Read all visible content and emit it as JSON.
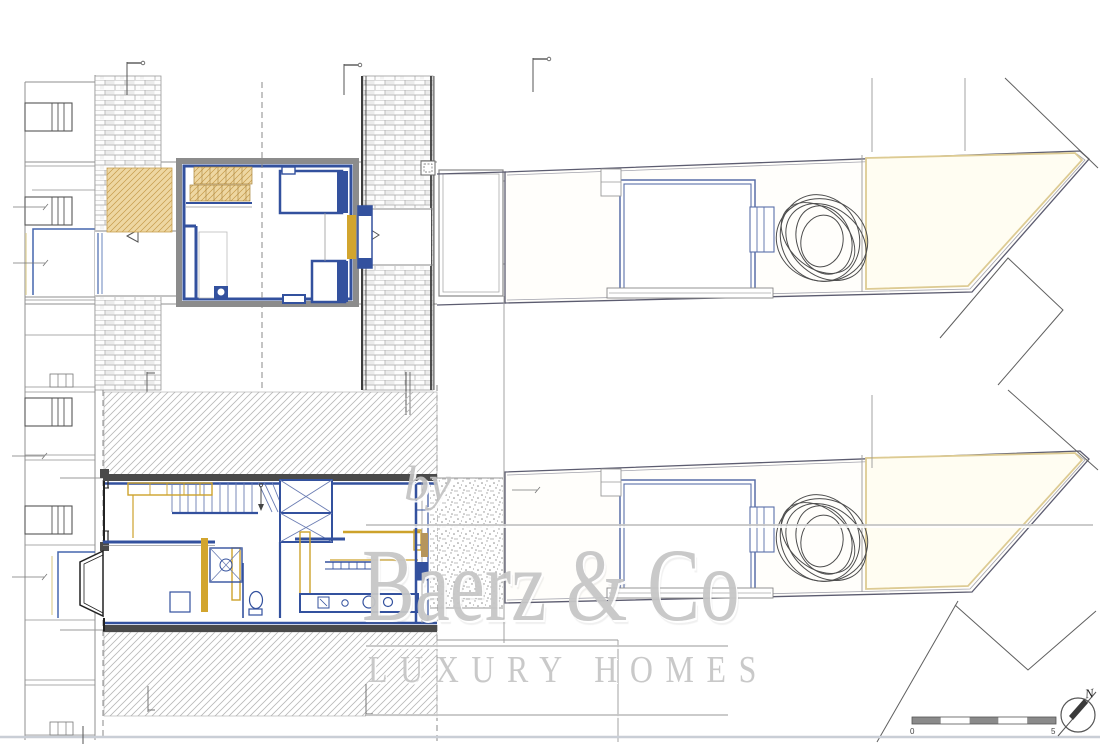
{
  "document": {
    "type": "architectural floor plan sheet (real-estate listing drawing)",
    "background": "#ffffff",
    "plans": {
      "upper_floor": {
        "name": "upper floor / roof plan",
        "features": [
          "brick-hatched pitched roof bands",
          "tan stair treads",
          "tan roof-terrace hatch",
          "blue bedroom walls",
          "dormer windows",
          "skylight symbol",
          "rear extension roof",
          "neighbouring house outline",
          "section marker flags"
        ]
      },
      "ground_floor": {
        "name": "ground floor plan",
        "features": [
          "entrance door",
          "bay window",
          "staircase with winders",
          "wardrobe with cross bracing",
          "bathroom with shower and toilet",
          "kitchen counter with stools",
          "dining bench",
          "mustard cabinetry strips",
          "rear glazed facade",
          "gravel terrace (stippled)",
          "party-wall diagonal hatching",
          "neighbouring house outline"
        ]
      },
      "site_plot": {
        "name": "garden plot plan (drawn twice, for both levels)",
        "features": [
          "tapered plot boundary ending in a point",
          "garden room (blue outline)",
          "annex step",
          "terrace edge band",
          "scribbled tree",
          "cream rear-garden zone",
          "neighbour parcel zigzag lines"
        ]
      }
    },
    "colors": {
      "wall_blue": "#33519e",
      "light_blue": "#6b7db3",
      "accent_mustard": "#d2a52e",
      "stair_tan": "#eed7a2",
      "hatch_gray": "#b8b8b8",
      "brick_gray": "#a6a6a6",
      "party_wall_dark": "#4a4a4a",
      "plot_boundary": "#5c5c70",
      "garden_yellow": "#ddcb93",
      "watermark_gray": "#c7c7c7"
    }
  },
  "watermark": {
    "by": "by",
    "brand": "Baerz & Co",
    "tagline": "LUXURY HOMES"
  },
  "scale_bar": {
    "start_label": "0",
    "end_label": "5"
  },
  "compass": {
    "label": "N"
  }
}
